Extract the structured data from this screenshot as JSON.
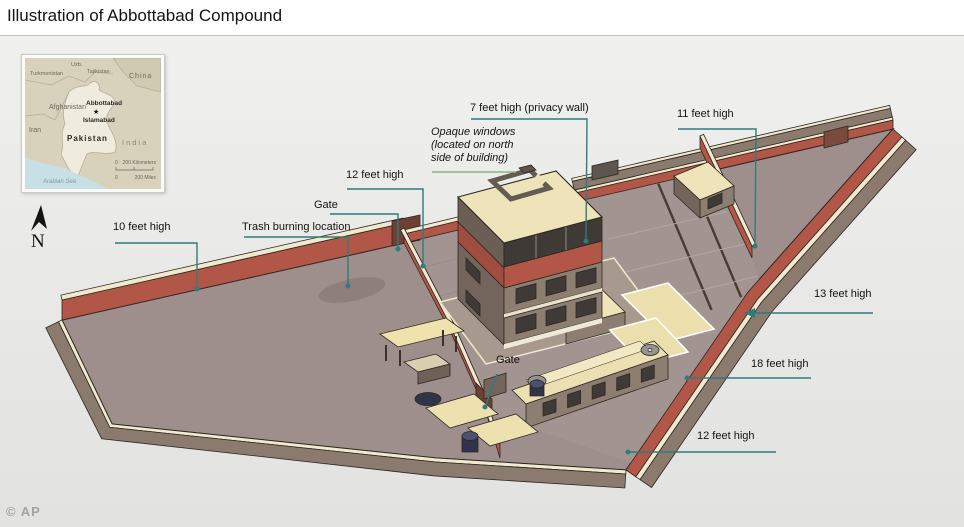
{
  "title": "Illustration of Abbottabad Compound",
  "credit": "© AP",
  "compass": {
    "label": "N"
  },
  "callouts": {
    "wall10": {
      "text": "10 feet high"
    },
    "trash": {
      "text": "Trash burning location"
    },
    "gate_north": {
      "text": "Gate"
    },
    "wall12_north": {
      "text": "12 feet high"
    },
    "opaque_windows": {
      "text": "Opaque windows\n(located on north\nside of building)"
    },
    "privacy_wall": {
      "text": "7 feet high (privacy wall)"
    },
    "wall11": {
      "text": "11 feet high"
    },
    "wall13": {
      "text": "13 feet high"
    },
    "wall18": {
      "text": "18 feet high"
    },
    "wall12_south": {
      "text": "12 feet high"
    },
    "gate_south": {
      "text": "Gate"
    }
  },
  "map": {
    "countries": {
      "turkmenistan": "Turkmenistan",
      "uzbekistan": "Uzb.",
      "tajikistan": "Tajikistan",
      "china": "China",
      "afghanistan": "Afghanistan",
      "iran": "Iran",
      "pakistan": "Pakistan",
      "india": "India"
    },
    "cities": {
      "abbottabad": "Abbottabad",
      "islamabad": "Islamabad"
    },
    "city_marker": "★",
    "sea": "Arabian Sea",
    "scale": {
      "zero": "0",
      "km": "200 Kilometers",
      "mi": "200 Miles"
    }
  },
  "palette": {
    "wall_red": "#b25748",
    "wall_red_dark": "#a04c3e",
    "gate_brown": "#6e4034",
    "gate_brown2": "#7a4a3c",
    "cream": "#f0e9cf",
    "roof_cream": "#efe3ba",
    "roof_cream2": "#f3e8c4",
    "patio_cream": "#ecdfae",
    "outer_gray": "#8a7b6e",
    "ground": "#9e8f8c",
    "ground_dark": "#8e7f7b",
    "court": "#a29490",
    "terrace": "#a8998f",
    "build_gray": "#8d7e72",
    "build_gray_dark": "#73655b",
    "build_shadow": "#6a5e55",
    "window_dark": "#3f3a36",
    "navy": "#2f3448",
    "navy_light": "#4a5173",
    "dish_gray": "#8e8e8a",
    "soil_line": "#453c34",
    "soil_line_light": "#b4a8a1",
    "outline": "#2e2722",
    "leader": "#2f7b7d",
    "sage": "#8fb381",
    "sea": "#c9dfe6",
    "land": "#d8d2bc",
    "land_dark": "#d0cab2",
    "pakistan": "#efecdd",
    "border_line": "#b5ae98"
  }
}
